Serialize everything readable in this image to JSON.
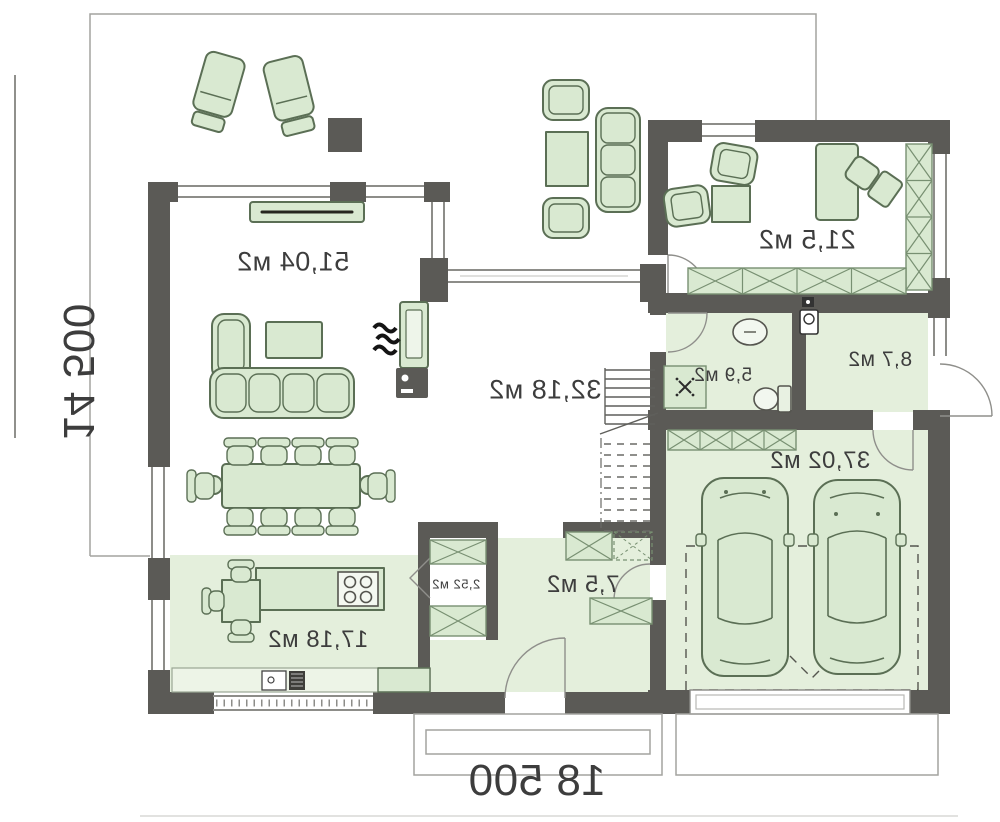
{
  "rooms": {
    "living": {
      "area": "51,04 м2"
    },
    "hall": {
      "area": "32,18 м2"
    },
    "office": {
      "area": "21,5 м2"
    },
    "bathroom": {
      "area": "5,9 м2"
    },
    "mudroom": {
      "area": "8,7 м2"
    },
    "garage": {
      "area": "37,02 м2"
    },
    "hallway": {
      "area": "7,5 м2"
    },
    "pantry": {
      "area": "2,52 м2"
    },
    "kitchen": {
      "area": "17,18 м2"
    }
  },
  "dimensions": {
    "width_label": "18 500",
    "height_label": "14 500"
  },
  "colors": {
    "wall": "#5b5a56",
    "furn": "#d9e9d1",
    "furnline": "#5b6f55",
    "floor": "#e4efdc",
    "hatline": "#789072",
    "winline": "#8d8d89",
    "thinline": "#a3a39f",
    "text": "#3d3d3d"
  }
}
